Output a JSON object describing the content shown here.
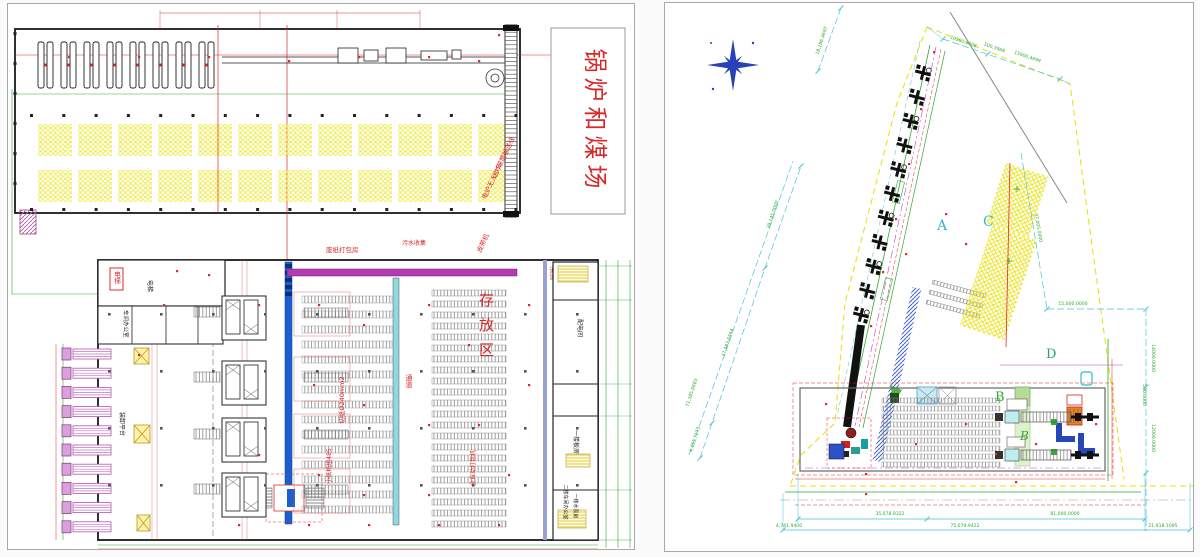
{
  "left_drawing": {
    "boiler_label": "锅炉和煤场",
    "labels": {
      "conveyor_line": "动力滚筒输送线",
      "agv": "电炉无人小车",
      "belt": "皮带机",
      "waste_packing": "废纸打包房",
      "sewage": "污水收集",
      "storage": "存放区",
      "cutting": "切纸Ø240mm2",
      "small_unit": "小纸机组485",
      "baler": "全自动打包机",
      "passage": "通道",
      "elevator": "电梯",
      "office": "车间办公室",
      "loading": "装卸平台",
      "power_room": "配电间",
      "board_room": "一楼板房",
      "office_2f": "二楼车间办公室",
      "pump_room": "一楼水泵房"
    }
  },
  "right_drawing": {
    "zones": {
      "a": "A",
      "b": "B",
      "b2": "B",
      "c": "C",
      "d": "D"
    },
    "dims": {
      "top1": "10360.9008",
      "top2": "500.3968",
      "top3": "15900.4699",
      "left_top": "18,186.4697",
      "left_seg3": "39,145.0000",
      "left_seg2": "37,483.6464",
      "left_seg1": "4,493.7173",
      "left_total": "72,385.6683",
      "right1": "37,005.0000",
      "right2": "15,000.0000",
      "right_v1": "500.0000",
      "right_v2": "12000.0000",
      "right_v3": "14000.0000",
      "bottom1": "35,078.9322",
      "bottom2": "81,000.0000",
      "bottom3": "4,741.9400",
      "bottom4": "75,079.9422",
      "bottom5": "21,918.1095"
    },
    "colors": {
      "dim_green": "#2faa2f",
      "dim_cyan": "#49c3d8",
      "zone_cyan": "#35b8cc",
      "boundary_yellow": "#e8e000",
      "compass_blue": "#2840b8"
    }
  }
}
